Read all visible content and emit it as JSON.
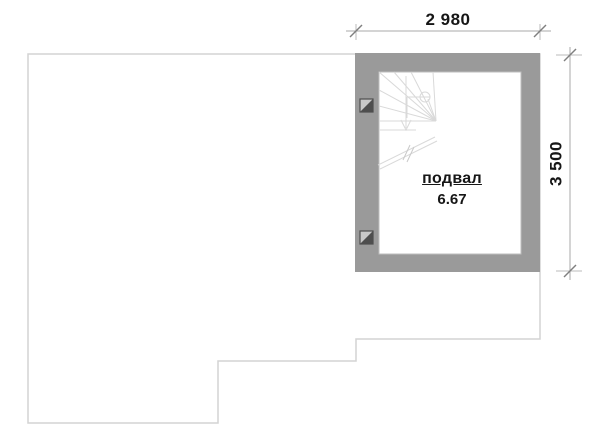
{
  "plan": {
    "room": {
      "label": "подвал",
      "area": "6.67"
    },
    "dimensions": {
      "width": "2 980",
      "height": "3 500"
    },
    "colors": {
      "wall_fill": "#9a9a9a",
      "outline": "#d4d4d4",
      "inner_edge": "#bdbdbd",
      "stair_lines": "#d9d9d9",
      "dim_line": "#a8a8a8",
      "dim_tick": "#7f7f7f",
      "dim_ext": "#bbbbbb",
      "marker_dark": "#4e4e4e",
      "marker_light": "#c8c8c8",
      "text": "#161616"
    },
    "icons": {
      "stair": "winder-stair-plan-icon",
      "wall_marker": "diagonal-split-square-icon"
    }
  }
}
